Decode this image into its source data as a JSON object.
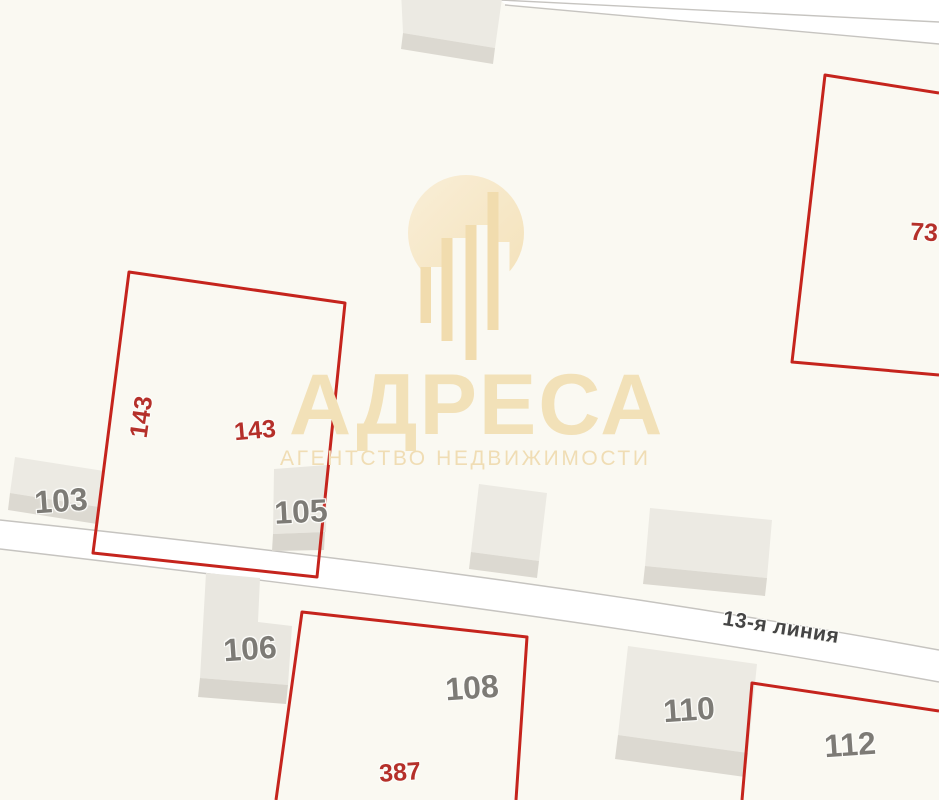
{
  "map": {
    "street": {
      "name": "13-я линия"
    },
    "watermark": {
      "brand": "АДРЕСА",
      "tagline": "АГЕНТСТВО НЕДВИЖИМОСТИ"
    },
    "labels": {
      "parcel_143_side": "143",
      "parcel_143": "143",
      "parcel_387": "387",
      "parcel_73": "73",
      "building_103": "103",
      "building_105": "105",
      "building_106": "106",
      "building_108": "108",
      "building_110": "110",
      "building_112": "112"
    },
    "colors": {
      "background": "#faf9f2",
      "road_fill": "#ffffff",
      "road_border": "#c6c4c0",
      "building_roof": "#eceae3",
      "building_side": "#dcd9d1",
      "parcel_outline": "#c5241d",
      "parcel_label": "#b5302a",
      "building_label": "#7d7b76",
      "street_label": "#454545",
      "watermark_gold": "#f2e1b8"
    }
  }
}
